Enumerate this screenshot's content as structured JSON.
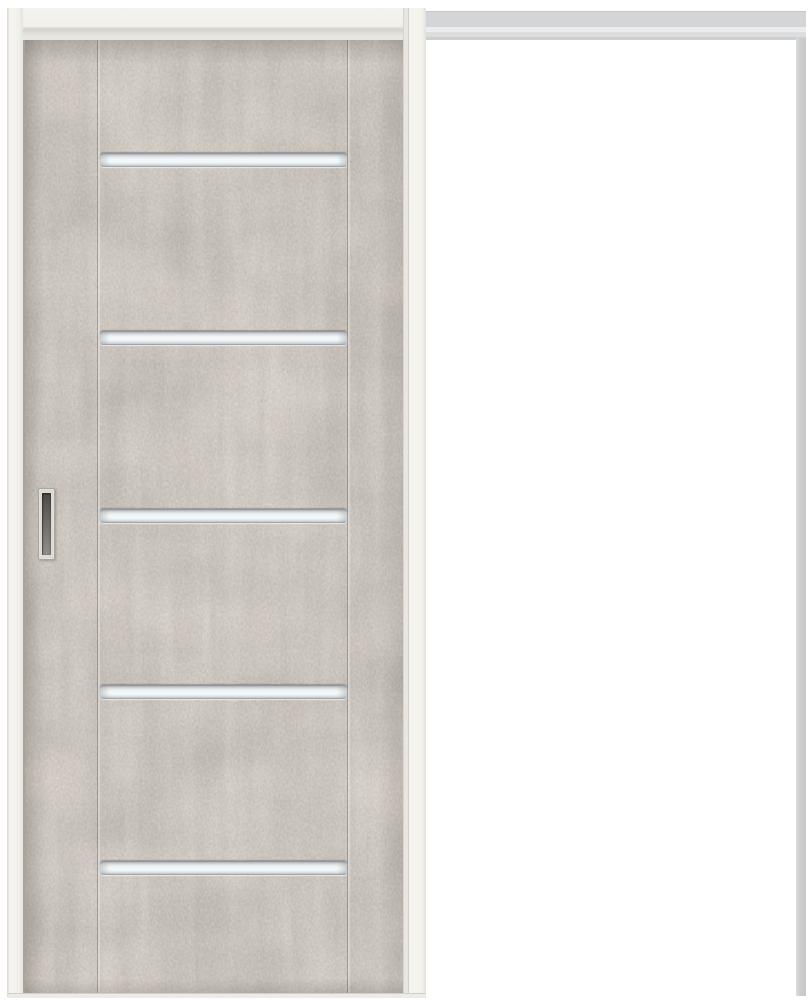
{
  "scene": {
    "kind": "product-photo",
    "subject": "Single-panel sliding pocket door with concrete-look gray finish, five horizontal frosted glass slats, recessed pull handle on left stile, cream-white door frame, gray overhead track, open white bay on the right"
  },
  "colors": {
    "bg": "#ffffff",
    "frame-cream": "#f5f3ed",
    "door-base": "#dad3cb",
    "door-average": "#b3aaa2",
    "rail-gray": "#d3d5d6",
    "rail-highlight": "#eaecee",
    "jamb-gray": "#cbcdce",
    "glass-center": "#f3f7f8",
    "glass-edge": "#bfc5c7",
    "handle-bezel": "#dcdbd5",
    "handle-recess-dark": "#4c4b46",
    "handle-recess-light": "#908f88"
  },
  "door": {
    "finish": "concrete-look",
    "state": "closed-over-left-half",
    "glass_slats": {
      "count": 5,
      "left_px": 75,
      "width_px": 247,
      "height_px": 14,
      "tops_px": [
        113,
        291,
        469,
        645,
        821
      ]
    },
    "grooves": {
      "xs_px": [
        72,
        322
      ]
    },
    "handle": {
      "type": "recessed-pull",
      "side": "left-stile"
    }
  }
}
